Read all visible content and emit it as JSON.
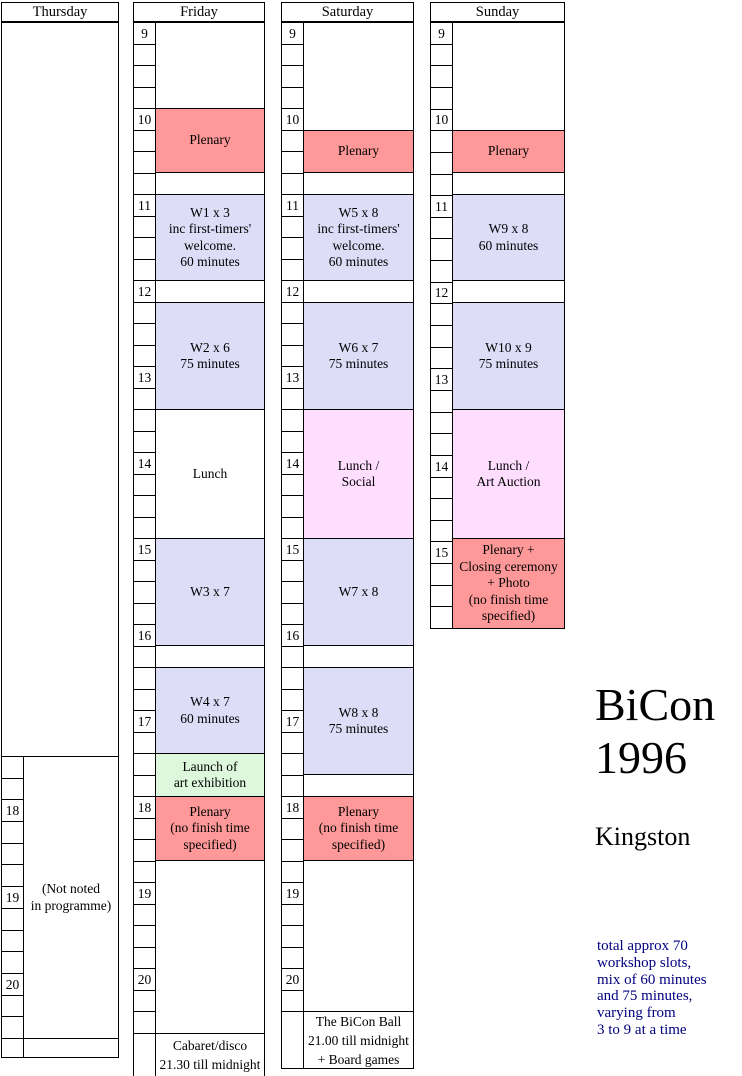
{
  "palette": {
    "plenary": "#FF9999",
    "workshop": "#DDDDF8",
    "social": "#FFDDFF",
    "launch": "#DDF8DD",
    "empty": "#FFFFFF",
    "border": "#000000",
    "note_text": "#000080"
  },
  "title": {
    "line1": "BiCon",
    "line2": "1996",
    "subtitle": "Kingston"
  },
  "note_lines": [
    "total approx 70",
    "workshop slots,",
    "mix of 60 minutes",
    "and 75 minutes,",
    "varying from",
    "3 to 9 at a time"
  ],
  "columns": [
    {
      "name": "thursday",
      "header": "Thursday",
      "left": 1,
      "width": 118,
      "tick_width": 22,
      "header_top": 2,
      "header_height": 20,
      "full_width_boxes": [
        {
          "name": "empty-day-area",
          "top": 22,
          "bottom": 756,
          "fill": "empty",
          "lines": []
        }
      ],
      "ticks": {
        "top": 756,
        "end": 1038,
        "count": 13,
        "labels": {
          "2": "18",
          "6": "19",
          "10": "20"
        }
      },
      "extra_tick_cells": [
        {
          "top": 1038,
          "bottom": 1057
        }
      ],
      "boxes": [
        {
          "name": "not-noted",
          "top": 756,
          "bottom": 1038,
          "fill": "empty",
          "lines": [
            "(Not noted",
            "in programme)"
          ]
        },
        {
          "name": "bottom-empty",
          "top": 1038,
          "bottom": 1057,
          "fill": "empty",
          "lines": []
        }
      ]
    },
    {
      "name": "friday",
      "header": "Friday",
      "left": 133,
      "width": 132,
      "tick_width": 22,
      "header_top": 2,
      "header_height": 20,
      "full_width_boxes": [],
      "ticks": {
        "top": 22,
        "end": 1033,
        "count": 47,
        "labels": {
          "0": "9",
          "4": "10",
          "8": "11",
          "12": "12",
          "16": "13",
          "20": "14",
          "24": "15",
          "28": "16",
          "32": "17",
          "36": "18",
          "40": "19",
          "44": "20"
        }
      },
      "extra_tick_cells": [
        {
          "top": 1033,
          "bottom": 1076
        }
      ],
      "boxes": [
        {
          "name": "gap-early",
          "top": 22,
          "bottom": 108,
          "fill": "empty",
          "lines": []
        },
        {
          "name": "plenary-morning",
          "top": 108,
          "bottom": 172,
          "fill": "plenary",
          "lines": [
            "Plenary"
          ]
        },
        {
          "name": "gap",
          "top": 172,
          "bottom": 194,
          "fill": "empty",
          "lines": []
        },
        {
          "name": "workshop-w1",
          "top": 194,
          "bottom": 280,
          "fill": "workshop",
          "lines": [
            "W1 x 3",
            "inc first-timers'",
            "welcome.",
            "60 minutes"
          ]
        },
        {
          "name": "gap",
          "top": 280,
          "bottom": 302,
          "fill": "empty",
          "lines": []
        },
        {
          "name": "workshop-w2",
          "top": 302,
          "bottom": 409,
          "fill": "workshop",
          "lines": [
            "W2 x 6",
            "75 minutes"
          ]
        },
        {
          "name": "lunch",
          "top": 409,
          "bottom": 538,
          "fill": "empty",
          "lines": [
            "Lunch"
          ]
        },
        {
          "name": "workshop-w3",
          "top": 538,
          "bottom": 645,
          "fill": "workshop",
          "lines": [
            "W3 x 7"
          ]
        },
        {
          "name": "gap",
          "top": 645,
          "bottom": 667,
          "fill": "empty",
          "lines": []
        },
        {
          "name": "workshop-w4",
          "top": 667,
          "bottom": 753,
          "fill": "workshop",
          "lines": [
            "W4 x 7",
            "60 minutes"
          ]
        },
        {
          "name": "art-exhibition-launch",
          "top": 753,
          "bottom": 796,
          "fill": "launch",
          "lines": [
            "Launch of",
            "art exhibition"
          ]
        },
        {
          "name": "plenary-evening",
          "top": 796,
          "bottom": 860,
          "fill": "plenary",
          "lines": [
            "Plenary",
            "(no finish time",
            "specified)"
          ]
        },
        {
          "name": "gap-evening",
          "top": 860,
          "bottom": 1033,
          "fill": "empty",
          "lines": []
        },
        {
          "name": "cabaret-disco",
          "top": 1033,
          "bottom": 1076,
          "fill": "empty",
          "tight": true,
          "lines": [
            "Cabaret/disco",
            "21.30 till midnight"
          ]
        }
      ]
    },
    {
      "name": "saturday",
      "header": "Saturday",
      "left": 281,
      "width": 133,
      "tick_width": 22,
      "header_top": 2,
      "header_height": 20,
      "full_width_boxes": [],
      "ticks": {
        "top": 22,
        "end": 1011,
        "count": 46,
        "labels": {
          "0": "9",
          "4": "10",
          "8": "11",
          "12": "12",
          "16": "13",
          "20": "14",
          "24": "15",
          "28": "16",
          "32": "17",
          "36": "18",
          "40": "19",
          "44": "20"
        }
      },
      "extra_tick_cells": [
        {
          "top": 1011,
          "bottom": 1068
        }
      ],
      "boxes": [
        {
          "name": "gap-early",
          "top": 22,
          "bottom": 130,
          "fill": "empty",
          "lines": []
        },
        {
          "name": "plenary-morning",
          "top": 130,
          "bottom": 172,
          "fill": "plenary",
          "lines": [
            "Plenary"
          ]
        },
        {
          "name": "gap",
          "top": 172,
          "bottom": 194,
          "fill": "empty",
          "lines": []
        },
        {
          "name": "workshop-w5",
          "top": 194,
          "bottom": 280,
          "fill": "workshop",
          "lines": [
            "W5 x 8",
            "inc first-timers'",
            "welcome.",
            "60 minutes"
          ]
        },
        {
          "name": "gap",
          "top": 280,
          "bottom": 302,
          "fill": "empty",
          "lines": []
        },
        {
          "name": "workshop-w6",
          "top": 302,
          "bottom": 409,
          "fill": "workshop",
          "lines": [
            "W6 x 7",
            "75 minutes"
          ]
        },
        {
          "name": "lunch-social",
          "top": 409,
          "bottom": 538,
          "fill": "social",
          "lines": [
            "Lunch /",
            "Social"
          ]
        },
        {
          "name": "workshop-w7",
          "top": 538,
          "bottom": 645,
          "fill": "workshop",
          "lines": [
            "W7 x 8"
          ]
        },
        {
          "name": "gap",
          "top": 645,
          "bottom": 667,
          "fill": "empty",
          "lines": []
        },
        {
          "name": "workshop-w8",
          "top": 667,
          "bottom": 774,
          "fill": "workshop",
          "lines": [
            "W8 x 8",
            "75 minutes"
          ]
        },
        {
          "name": "gap",
          "top": 774,
          "bottom": 796,
          "fill": "empty",
          "lines": []
        },
        {
          "name": "plenary-evening",
          "top": 796,
          "bottom": 860,
          "fill": "plenary",
          "lines": [
            "Plenary",
            "(no finish time",
            "specified)"
          ]
        },
        {
          "name": "gap-evening",
          "top": 860,
          "bottom": 1011,
          "fill": "empty",
          "lines": []
        },
        {
          "name": "bicon-ball",
          "top": 1011,
          "bottom": 1068,
          "fill": "empty",
          "tight": true,
          "lines": [
            "The BiCon Ball",
            "21.00 till midnight",
            "+ Board games"
          ]
        }
      ]
    },
    {
      "name": "sunday",
      "header": "Sunday",
      "left": 430,
      "width": 135,
      "tick_width": 22,
      "header_top": 2,
      "header_height": 20,
      "full_width_boxes": [],
      "ticks": {
        "top": 22,
        "end": 628,
        "count": 28,
        "labels": {
          "0": "9",
          "4": "10",
          "8": "11",
          "12": "12",
          "16": "13",
          "20": "14",
          "24": "15"
        }
      },
      "extra_tick_cells": [],
      "boxes": [
        {
          "name": "gap-early",
          "top": 22,
          "bottom": 130,
          "fill": "empty",
          "lines": []
        },
        {
          "name": "plenary-morning",
          "top": 130,
          "bottom": 172,
          "fill": "plenary",
          "lines": [
            "Plenary"
          ]
        },
        {
          "name": "gap",
          "top": 172,
          "bottom": 194,
          "fill": "empty",
          "lines": []
        },
        {
          "name": "workshop-w9",
          "top": 194,
          "bottom": 280,
          "fill": "workshop",
          "lines": [
            "W9 x 8",
            "60 minutes"
          ]
        },
        {
          "name": "gap",
          "top": 280,
          "bottom": 302,
          "fill": "empty",
          "lines": []
        },
        {
          "name": "workshop-w10",
          "top": 302,
          "bottom": 409,
          "fill": "workshop",
          "lines": [
            "W10 x 9",
            "75 minutes"
          ]
        },
        {
          "name": "lunch-art-auction",
          "top": 409,
          "bottom": 538,
          "fill": "social",
          "lines": [
            "Lunch /",
            "Art Auction"
          ]
        },
        {
          "name": "closing-plenary",
          "top": 538,
          "bottom": 628,
          "fill": "plenary",
          "lines": [
            "Plenary +",
            "Closing ceremony",
            "+ Photo",
            "(no finish time",
            "specified)"
          ]
        }
      ]
    }
  ]
}
